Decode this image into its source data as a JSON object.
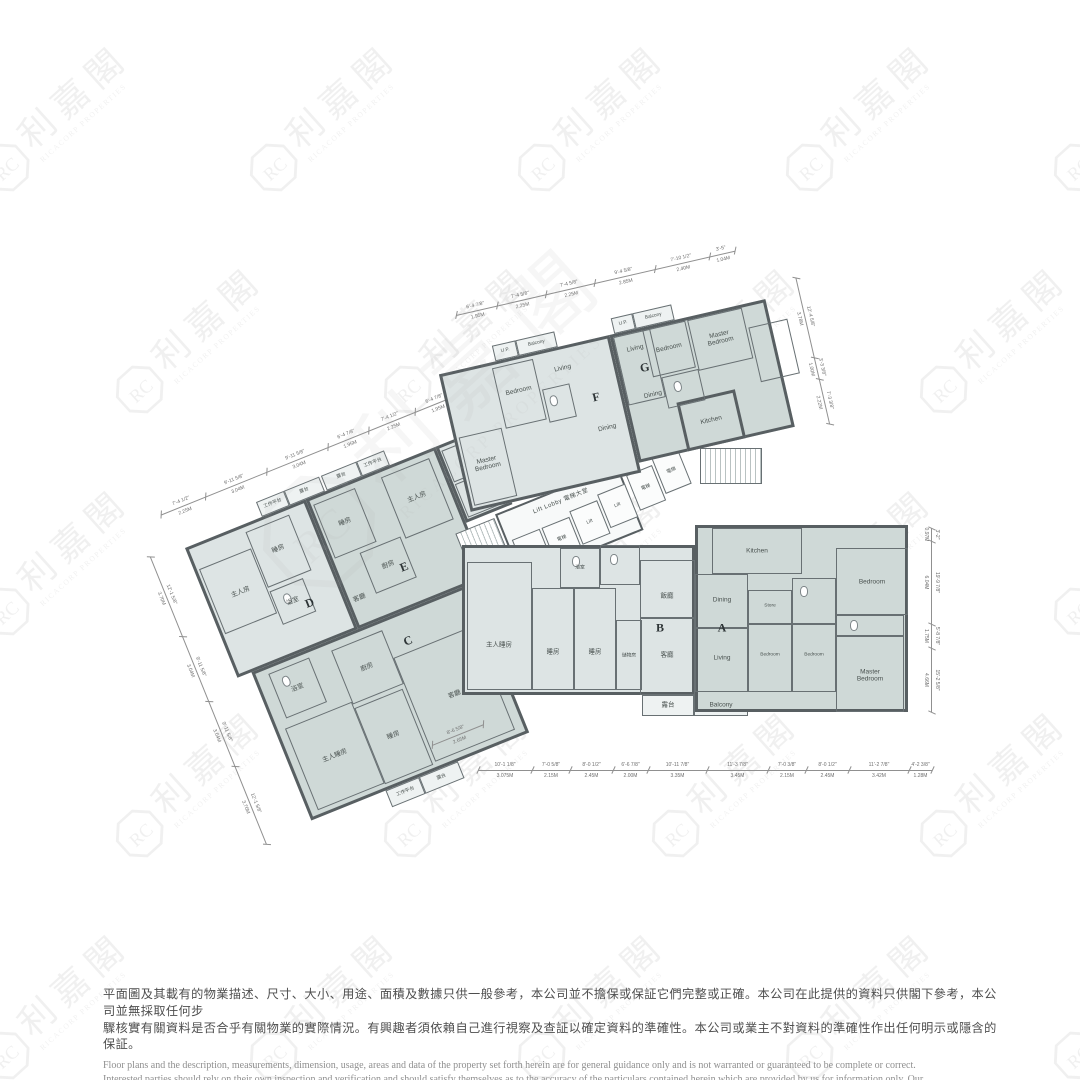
{
  "watermark": {
    "cn": "利嘉閣",
    "en": "RICACORP PROPERTIES",
    "monogram": "RC"
  },
  "floorplan": {
    "units": {
      "A": {
        "letter": "A",
        "rooms": [
          "Kitchen",
          "Dining",
          "Living",
          "Store",
          "Bedroom",
          "Bedroom",
          "Bedroom",
          "Master Bedroom"
        ]
      },
      "B": {
        "letter": "B",
        "rooms": [
          "主人睡房",
          "睡房",
          "睡房",
          "儲物房",
          "浴室",
          "飯廳",
          "客廳"
        ]
      },
      "C": {
        "letter": "C",
        "rooms": [
          "主人睡房",
          "睡房",
          "客廳",
          "廚房",
          "浴室",
          "工作平台",
          "露台"
        ]
      },
      "D": {
        "letter": "D",
        "rooms": [
          "主人房",
          "睡房",
          "浴室",
          "工作平台",
          "露台"
        ]
      },
      "E": {
        "letter": "E",
        "rooms": [
          "睡房",
          "主人房",
          "廚房",
          "客廳",
          "露台",
          "工作平台"
        ]
      },
      "F": {
        "letter": "F",
        "rooms": [
          "Living",
          "Dining",
          "Bedroom",
          "Master Bedroom",
          "U.P.",
          "Balcony"
        ]
      },
      "G": {
        "letter": "G",
        "rooms": [
          "Living",
          "Dining",
          "Bedroom",
          "Master Bedroom",
          "Kitchen",
          "U.P.",
          "Balcony"
        ]
      }
    },
    "balcony_strip": {
      "zh": "露台",
      "en": "Balcony"
    },
    "core": {
      "lift_lobby": "Lift Lobby 電梯大堂",
      "lift_en": "Lift",
      "lift_zh": "電梯"
    },
    "dimensions": {
      "topLeft": [
        [
          "7'-4 1/2\"",
          "2.25M"
        ],
        [
          "9'-11 5/8\"",
          "3.04M"
        ],
        [
          "9'-11 5/8\"",
          "3.04M"
        ],
        [
          "6'-4 7/8\"",
          "1.95M"
        ],
        [
          "7'-4 1/2\"",
          "2.25M"
        ],
        [
          "6'-4 7/8\"",
          "1.95M"
        ]
      ],
      "topRight": [
        [
          "6'-4 7/8\"",
          "1.95M"
        ],
        [
          "7'-4 5/8\"",
          "2.25M"
        ],
        [
          "7'-4 5/8\"",
          "2.25M"
        ],
        [
          "9'-4 5/8\"",
          "2.85M"
        ],
        [
          "7'-10 1/2\"",
          "2.40M"
        ],
        [
          "3'-5\"",
          "1.04M"
        ]
      ],
      "bottom": [
        [
          "10'-1 1/8\"",
          "3.075M"
        ],
        [
          "7'-0 5/8\"",
          "2.15M"
        ],
        [
          "8'-0 1/2\"",
          "2.45M"
        ],
        [
          "6'-6 7/8\"",
          "2.00M"
        ],
        [
          "10'-11 7/8\"",
          "3.35M"
        ],
        [
          "11'-3 7/8\"",
          "3.45M"
        ],
        [
          "7'-0 3/8\"",
          "2.15M"
        ],
        [
          "8'-0 1/2\"",
          "2.45M"
        ],
        [
          "11'-2 7/8\"",
          "3.42M"
        ],
        [
          "4'-2 3/8\"",
          "1.28M"
        ]
      ],
      "right": [
        [
          "3'-2\"",
          "0.97M"
        ],
        [
          "19'-9 7/8\"",
          "6.04M"
        ],
        [
          "5'-8 7/8\"",
          "1.75M"
        ],
        [
          "15'-2 5/8\"",
          "4.66M"
        ]
      ],
      "left": [
        [
          "12'-1 5/8\"",
          "3.70M"
        ],
        [
          "9'-11 5/8\"",
          "3.04M"
        ],
        [
          "9'-11 5/8\"",
          "3.04M"
        ],
        [
          "12'-1 5/8\"",
          "3.70M"
        ]
      ],
      "gright": [
        [
          "12'-4 5/8\"",
          "3.78M"
        ],
        [
          "3'-3 3/8\"",
          "1.00M"
        ],
        [
          "7'-3 3/8\"",
          "2.22M"
        ]
      ],
      "small": [
        [
          "8'-6 5/8\"",
          "2.65M"
        ]
      ]
    }
  },
  "disclaimer": {
    "zh": [
      "平面圖及其載有的物業描述、尺寸、大小、用途、面積及數據只供一般參考，本公司並不擔保或保証它們完整或正確。本公司在此提供的資料只供閣下參考，本公司並無採取任何步",
      "驟核實有關資料是否合乎有關物業的實際情況。有興趣者須依賴自己進行視察及查証以確定資料的準確性。本公司或業主不對資料的準確性作出任何明示或隱含的保証。"
    ],
    "en": [
      "Floor plans and the description, measurements, dimension, usage, areas and data of the property set forth herein are for general guidance only and is not warranted or guaranteed to be complete or correct.",
      "Interested parties should rely on their own inspection and verification and should satisfy themselves as to the accuracy of the particulars contained herein which are provided by us for information only.  Our",
      "Company has not taken any step to verify whether the information reflects the actual status of the property.  No warranty for accuracy is given or implied by the owners or us."
    ]
  }
}
